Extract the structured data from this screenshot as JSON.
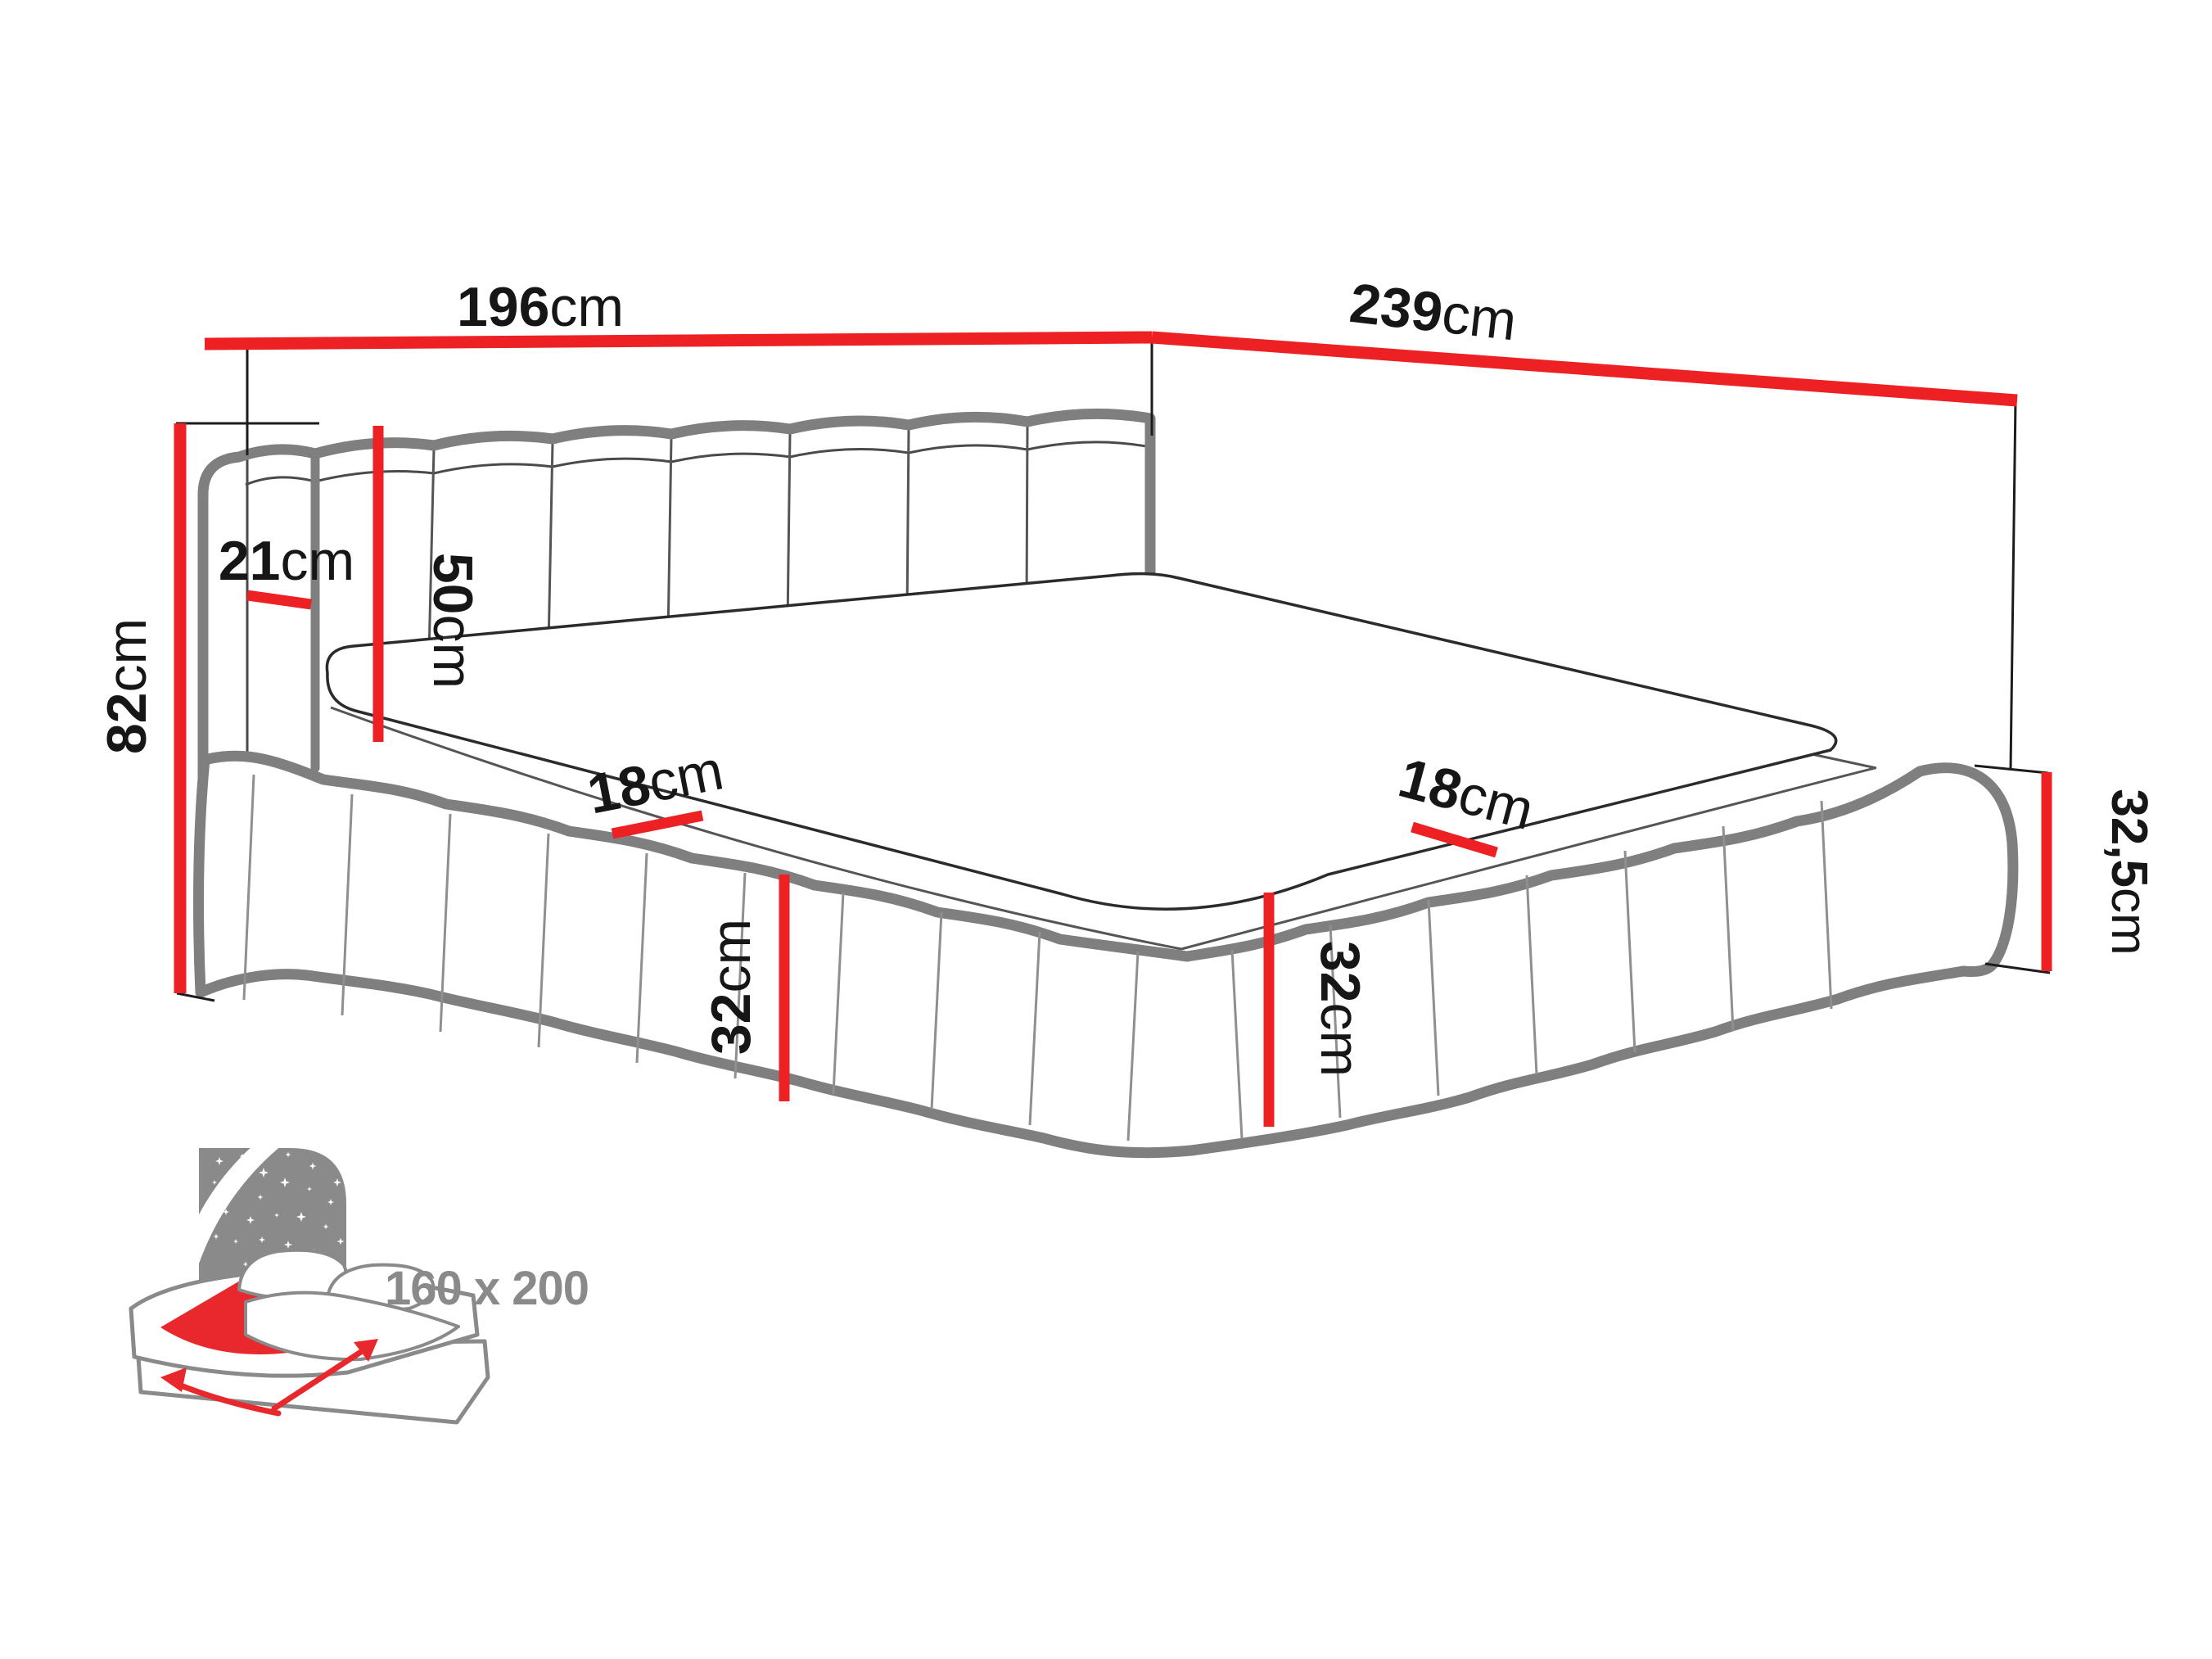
{
  "dimensions": {
    "width_top": {
      "value": "196",
      "unit": "cm"
    },
    "depth_top": {
      "value": "239",
      "unit": "cm"
    },
    "total_height_left": {
      "value": "82",
      "unit": "cm"
    },
    "headboard_side_width": {
      "value": "21",
      "unit": "cm"
    },
    "headboard_above_base": {
      "value": "50",
      "unit": "cm"
    },
    "base_rim_left": {
      "value": "18",
      "unit": "cm"
    },
    "base_rim_right": {
      "value": "18",
      "unit": "cm"
    },
    "base_height_left": {
      "value": "32",
      "unit": "cm"
    },
    "base_height_right": {
      "value": "32",
      "unit": "cm"
    },
    "base_height_back": {
      "value": "32,5",
      "unit": "cm"
    }
  },
  "icon": {
    "mattress_size": "160 x 200"
  },
  "colors": {
    "dimension_red": "#ed2024",
    "outline_gray": "#808080",
    "thin_line_dark": "#2b2b2b",
    "icon_gray": "#8a8a8a",
    "icon_red": "#e8282c",
    "text_dark": "#161616"
  }
}
